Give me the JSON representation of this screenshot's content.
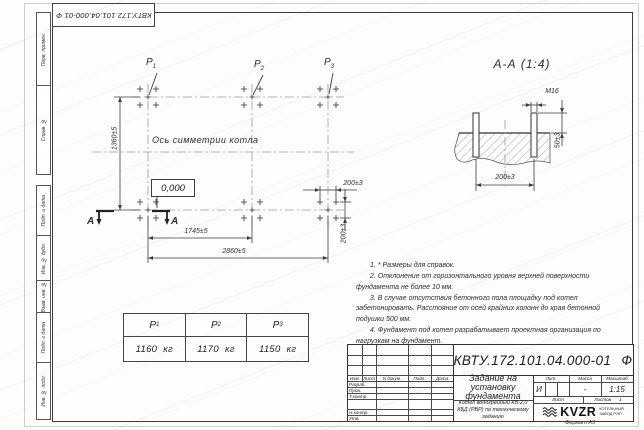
{
  "doc": {
    "number": "КВТУ.172.101.04.000-01",
    "suffix": "Ф"
  },
  "sheet": {
    "format_label": "Формат А3"
  },
  "margin_labels": [
    "Перв. примен.",
    "Справ. №",
    "Подп. и дата",
    "Инв. № дубл.",
    "Взам. инв. №",
    "Подп. и дата",
    "Инв. № подл."
  ],
  "plan": {
    "points": [
      {
        "base": "P",
        "sub": "1"
      },
      {
        "base": "P",
        "sub": "2"
      },
      {
        "base": "P",
        "sub": "3"
      }
    ],
    "axis_label": "Ось симметрии котла",
    "elevation": "0,000",
    "section_letter": "А",
    "dim_height": "1360±5",
    "dim_mid": "1745±5",
    "dim_total": "2860±5",
    "dim_bolt_x": "200±3",
    "dim_bolt_y": "200±3"
  },
  "section": {
    "title": "А-А (1:4)",
    "thread": "М16",
    "protrusion": "50±3",
    "spacing": "200±3"
  },
  "notes": [
    "1. * Размеры для справок.",
    "2. Отклонение от горизонтального уровня верхней поверхности фундамента не более 10 мм.",
    "3. В случае отсутствия бетонного пола площадку под котел забетонировать. Расстояние от осей крайних колонн до края бетонной подушки 500 мм.",
    "4. Фундамент под котел разрабатывает проектная организация по нагрузкам на фундамент."
  ],
  "load_table": {
    "columns": [
      {
        "base": "P",
        "sub": "1",
        "load": "1160",
        "unit": "кг"
      },
      {
        "base": "P",
        "sub": "2",
        "load": "1170",
        "unit": "кг"
      },
      {
        "base": "P",
        "sub": "3",
        "load": "1150",
        "unit": "кг"
      }
    ]
  },
  "title_block": {
    "rev_cols": [
      "Изм.",
      "Лист",
      "N докум.",
      "Подп.",
      "Дата"
    ],
    "roles": [
      "Разраб.",
      "Пров.",
      "Т.контр.",
      "Н.контр.",
      "Утв."
    ],
    "title": "Задание на установку фундамента",
    "subtitle": "Котел водогрейный КВ-2,0 КБД (РВР) по техническому заданию",
    "lit_label": "Лит.",
    "mass_label": "Масса",
    "scale_label": "Масштаб",
    "lit": "И",
    "mass": "-",
    "scale": "1:15",
    "sheet_label": "Лист",
    "sheets_label": "Листов",
    "sheets_count": "1",
    "logo_text": "KVZR",
    "logo_caption_line1": "КОТЕЛЬНЫЙ",
    "logo_caption_line2": "ЗАВОД РЭП"
  }
}
